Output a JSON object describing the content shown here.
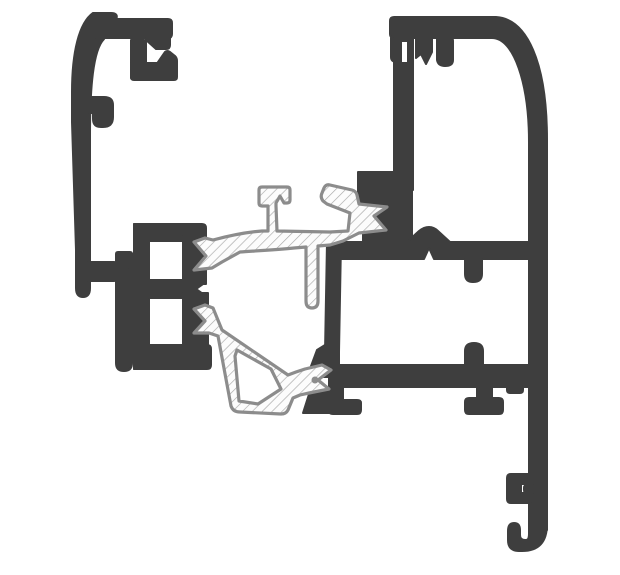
{
  "canvas": {
    "width": 620,
    "height": 575,
    "background": "#ffffff"
  },
  "colors": {
    "aluminum": "#3e3e3e",
    "polymer_outline": "#8c8c8c",
    "polymer_fill": "#fcfcfc",
    "polymer_hatch_line": "#a8a8a8"
  },
  "drawing": {
    "type": "technical-cross-section",
    "subject": "Aluminium window frame and sash profile section with polymer thermal break and tubular gasket",
    "parts": [
      {
        "id": "outer-frame-cover-profile",
        "material": "aluminium",
        "render": "solid-dark"
      },
      {
        "id": "glazing-clip-profile",
        "material": "aluminium",
        "render": "solid-dark"
      },
      {
        "id": "thermal-break-insert",
        "material": "polymer",
        "render": "hatched"
      },
      {
        "id": "tubular-gasket",
        "material": "polymer",
        "render": "hatched"
      },
      {
        "id": "sash-box-profile",
        "material": "aluminium",
        "render": "solid-dark"
      }
    ]
  }
}
